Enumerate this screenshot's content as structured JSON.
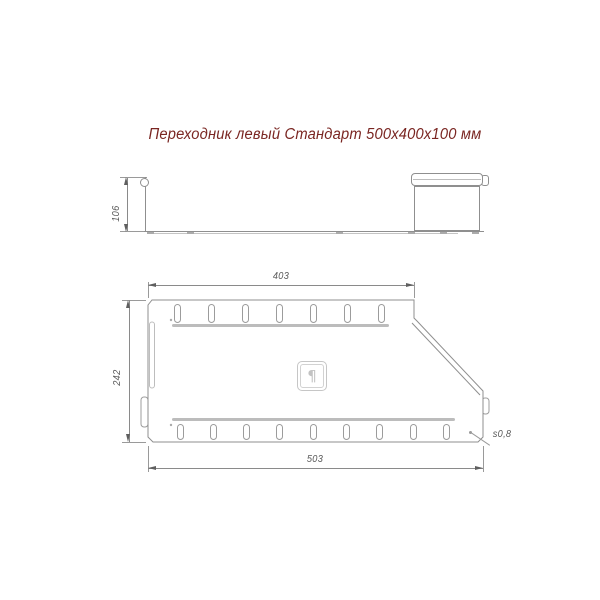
{
  "title": "Переходник левый Стандарт 500x400x100 мм",
  "colors": {
    "title_text": "#7a2622",
    "outline": "#8f8f8f",
    "dimension": "#5a5a5a",
    "rib": "#bcbcbc",
    "logo": "#c2c2c2"
  },
  "side_view": {
    "height_dim": "106"
  },
  "plan_view": {
    "top_dim": "403",
    "left_dim": "242",
    "bottom_dim": "503",
    "thickness_label": "s0,8",
    "top_slot_count": 7,
    "bottom_slot_count": 9
  },
  "logo": {
    "icon": "manufacturer-logo-icon",
    "glyph": "¶"
  }
}
